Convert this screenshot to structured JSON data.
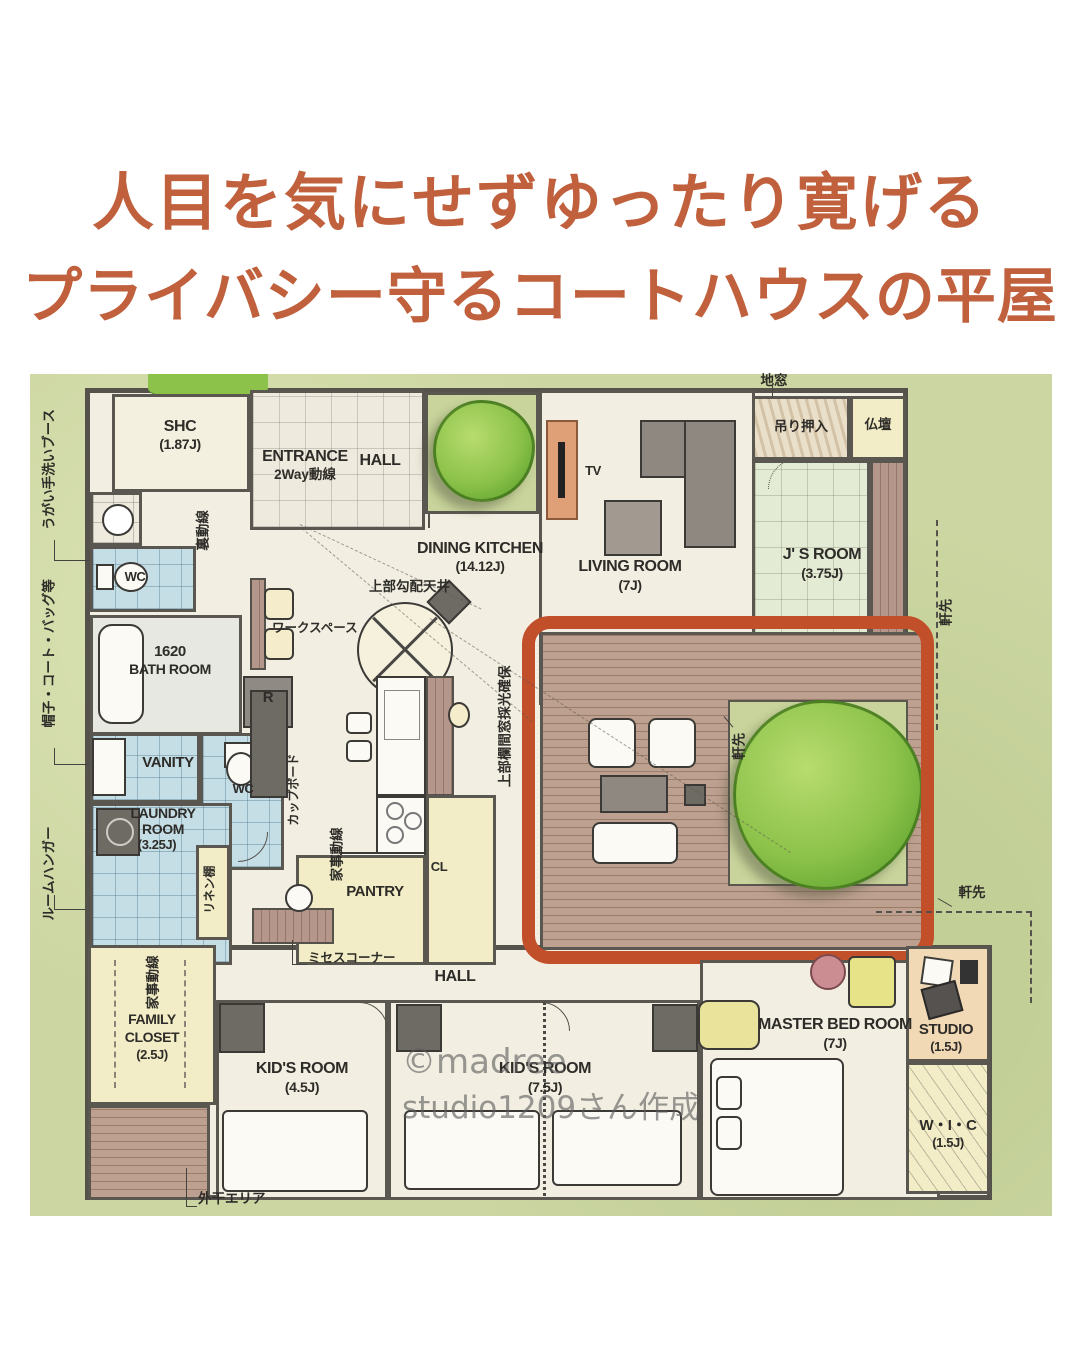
{
  "title": {
    "line1": "人目を気にせずゆったり寛げる",
    "line2": "プライバシー守るコートハウスの平屋",
    "color": "#c0603c"
  },
  "watermark": {
    "line1": "©madree",
    "line2": "studio1209さん作成"
  },
  "colors": {
    "accent": "#c0603c",
    "highlight_box": "#c14f2a",
    "site_green": "#ccd6a2",
    "wall": "#55524c",
    "floor_cream": "#f2eee1",
    "tatami_green": "#e3ebd4",
    "wet_blue": "#c5dde5",
    "closet_yellow": "#f2edc6",
    "deck_wood": "#bda08f"
  },
  "labels": {
    "shc": "SHC",
    "shc_size": "(1.87J)",
    "entrance": "ENTRANCE",
    "entrance_sub": "2Way動線",
    "hall": "HALL",
    "dining_kitchen": "DINING KITCHEN",
    "dining_kitchen_size": "(14.12J)",
    "living": "LIVING ROOM",
    "living_size": "(7J)",
    "tv": "TV",
    "jimado": "地窓",
    "tsuri_oshiire": "吊り押入",
    "butsudan": "仏壇",
    "js_room": "J' S ROOM",
    "js_room_size": "(3.75J)",
    "nokisaki": "軒先",
    "joubu_kouhai_tenjo": "上部勾配天井",
    "ranma": "上部欄間窓採光確保",
    "workspace": "ワークスペース",
    "ura_dousen": "裏動線",
    "kaji_dousen": "家事動線",
    "bath_num": "1620",
    "bath": "BATH ROOM",
    "r": "R",
    "vanity": "VANITY",
    "wc": "WC",
    "laundry1": "LAUNDRY",
    "laundry2": "ROOM",
    "laundry_size": "(3.25J)",
    "linen": "リネン棚",
    "cupboard": "カップボード",
    "pantry": "PANTRY",
    "cl": "CL",
    "misses_corner": "ミセスコーナー",
    "family1": "FAMILY",
    "family2": "CLOSET",
    "family_size": "(2.5J)",
    "sotoboshi": "外干エリア",
    "kids": "KID'S ROOM",
    "kids1_size": "(4.5J)",
    "kids2_size": "(7.5J)",
    "master": "MASTER  BED ROOM",
    "master_size": "(7J)",
    "studio": "STUDIO",
    "studio_size": "(1.5J)",
    "wic": "W・I・C",
    "wic_size": "(1.5J)",
    "margin_wash": "うがい手洗いブース",
    "margin_bag": "帽子・コート・バッグ等",
    "margin_hanger": "ルームハンガー"
  }
}
